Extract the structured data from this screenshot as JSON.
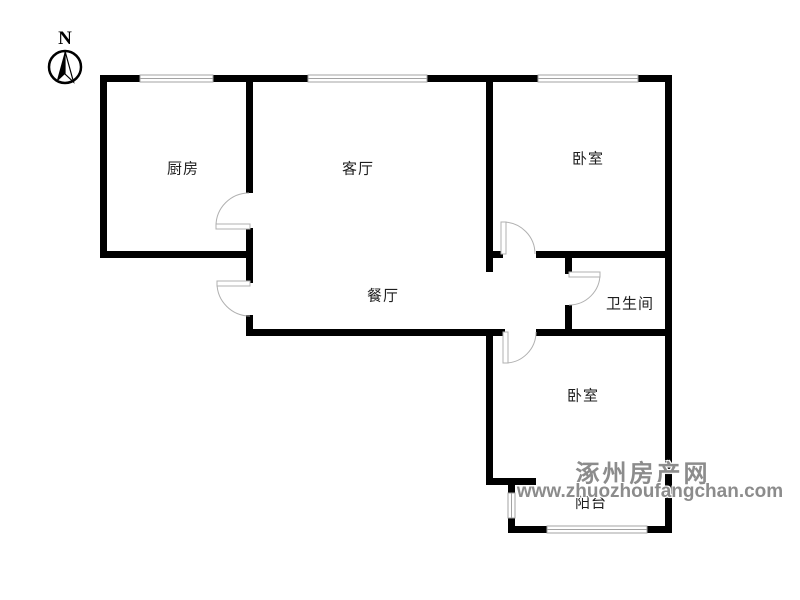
{
  "compass": {
    "label": "N"
  },
  "rooms": {
    "kitchen": {
      "label": "厨房"
    },
    "living_room": {
      "label": "客厅"
    },
    "bedroom_top": {
      "label": "卧室"
    },
    "dining_room": {
      "label": "餐厅"
    },
    "bathroom": {
      "label": "卫生间"
    },
    "bedroom_bottom": {
      "label": "卧室"
    },
    "balcony": {
      "label": "阳台"
    }
  },
  "watermark": {
    "site_name": "涿州房产网",
    "site_url": "www.zhuozhoufangchan.com"
  },
  "colors": {
    "wall": "#000000",
    "window_line": "#a3a3a3",
    "door_line": "#b0b0b0",
    "label_text": "#1f1f1f",
    "watermark_text": "#8c8c8c",
    "background": "#ffffff"
  }
}
